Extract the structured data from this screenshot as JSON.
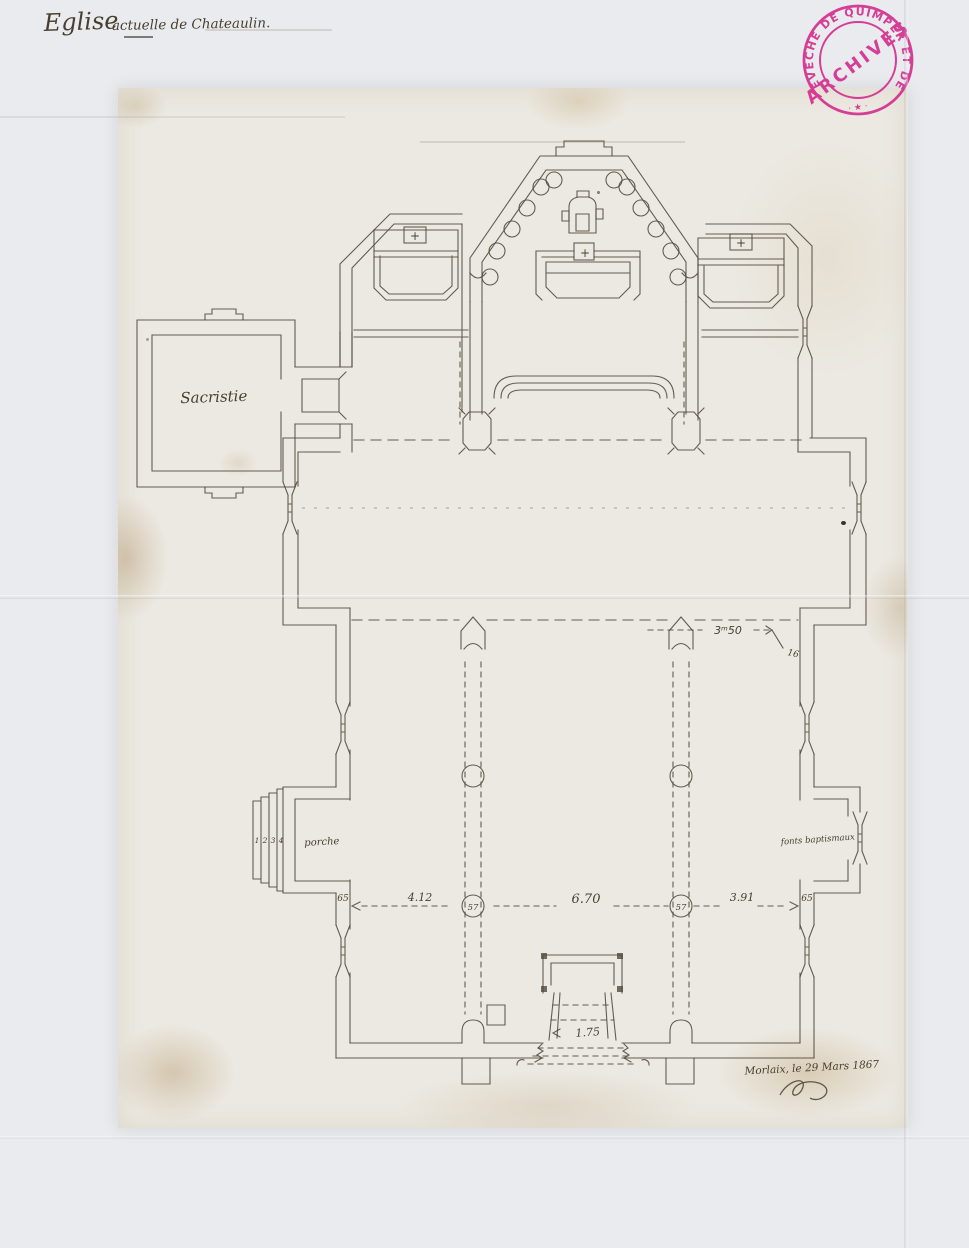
{
  "title": {
    "lead_word": "Eglise",
    "rest": "actuelle de Chateaulin."
  },
  "stamp": {
    "ring_text": "ÉVÊCHÉ DE QUIMPER ET DE LÉON",
    "center_text": "ARCHIVES",
    "bottom_mark": "· ★ ·",
    "color": "#d4308e"
  },
  "plan": {
    "labels": {
      "sacristy": "Sacristie",
      "porch": "porche",
      "baptismal_fonts": "fonts baptismaux"
    },
    "porch_steps": [
      "1",
      "2",
      "3",
      "4"
    ],
    "altar_marks": {
      "left_chapel": "+",
      "high_altar": "+",
      "right_chapel": "+"
    },
    "dimensions": {
      "bay_width": "3ᵐ50",
      "bay_note": "16",
      "wall_left": "65",
      "aisle_left": "4.12",
      "column_left": "57",
      "nave_center": "6.70",
      "column_right": "57",
      "aisle_right": "3.91",
      "wall_right": "65",
      "door_width": "1.75"
    },
    "ink_color": "#51483b"
  },
  "inscription": {
    "place_date": "Morlaix, le 29 Mars 1867"
  }
}
